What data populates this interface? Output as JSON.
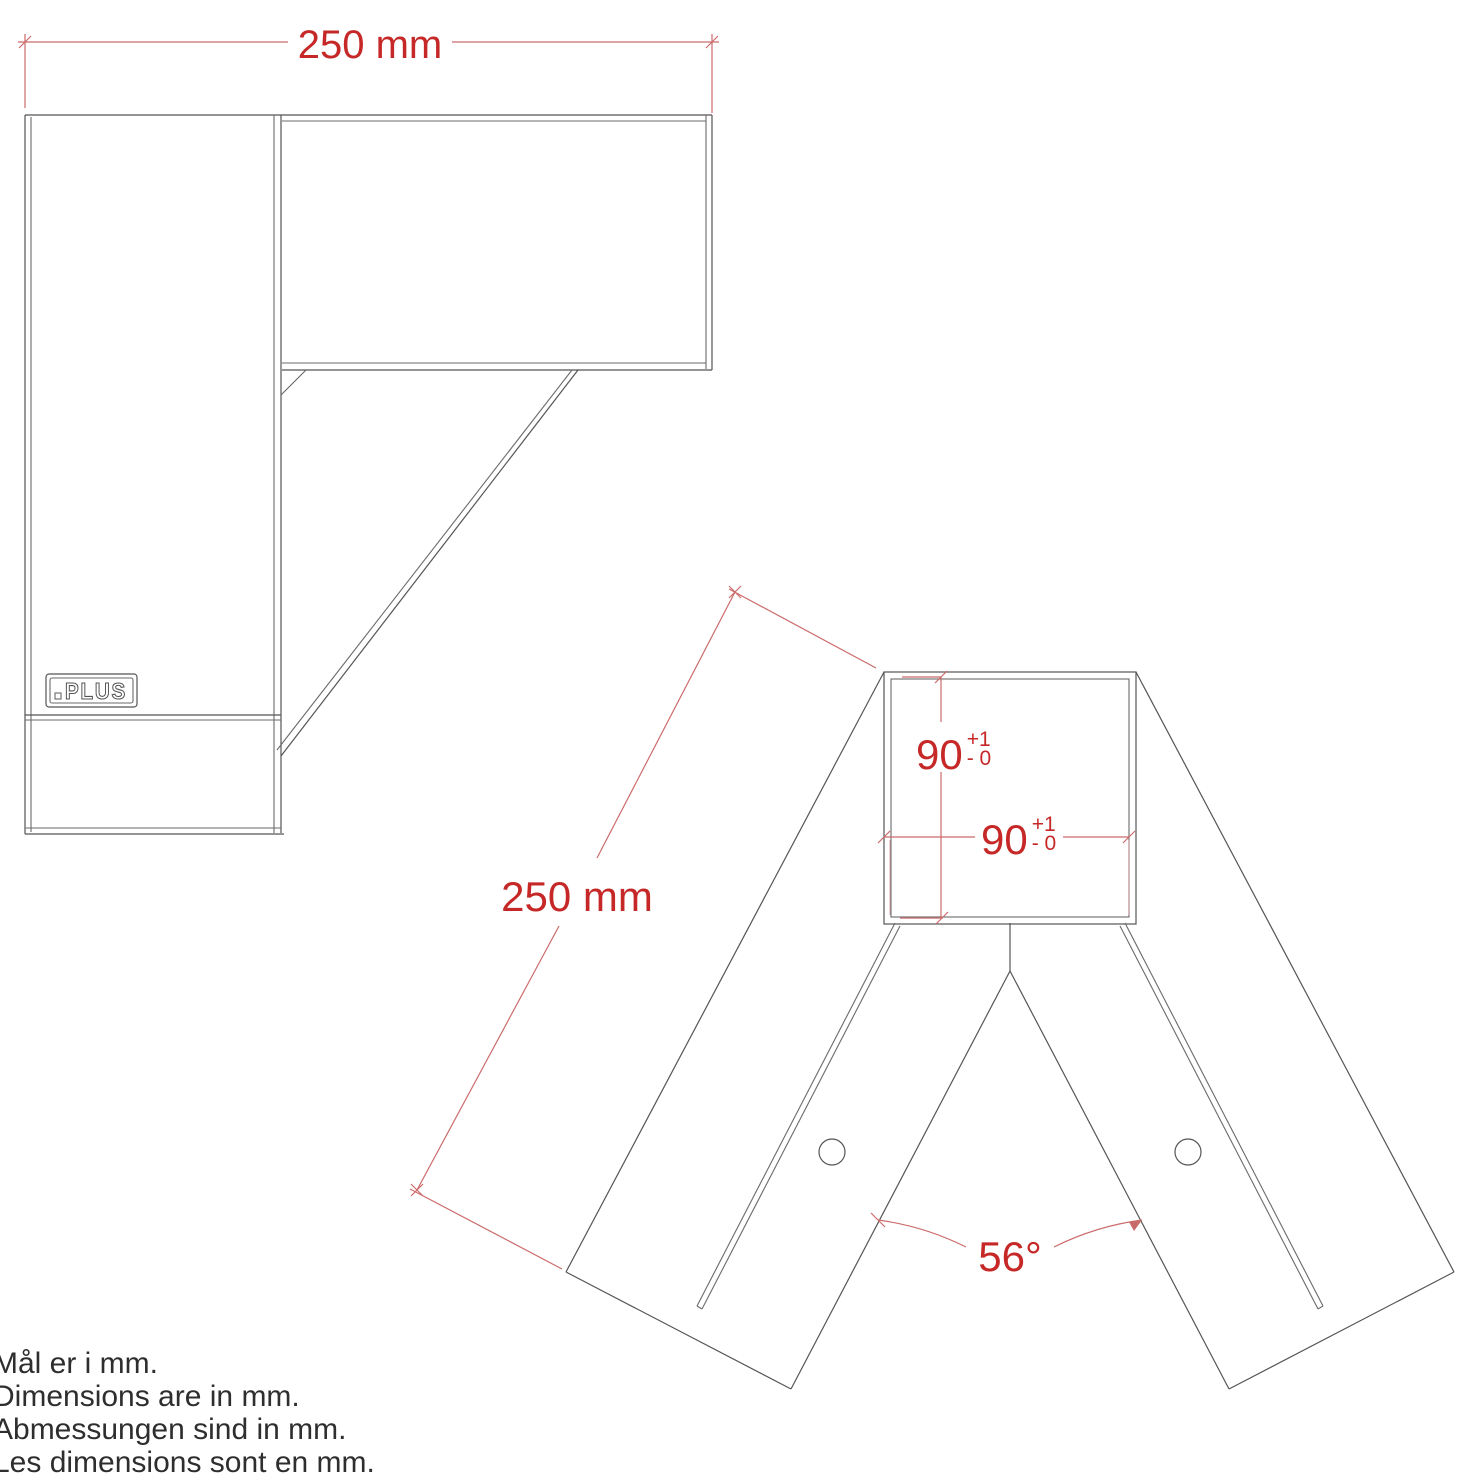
{
  "canvas": {
    "background": "#ffffff",
    "drawing_line_color": "#555555",
    "dimension_line_color": "#cc6b6b",
    "dimension_text_color": "#c62828"
  },
  "side_view": {
    "description": "post-bracket-side-view",
    "width_dim_label": "250 mm",
    "logo_text": "PLUS"
  },
  "front_view": {
    "description": "a-frame-bracket-front-view",
    "leg_length_dim_label": "250 mm",
    "inner_height_dim": {
      "value": "90",
      "tol_upper": "+1",
      "tol_lower": "- 0"
    },
    "inner_width_dim": {
      "value": "90",
      "tol_upper": "+1",
      "tol_lower": "- 0"
    },
    "leg_angle_dim_label": "56°"
  },
  "notes": [
    "Mål er i mm.",
    "Dimensions are in mm.",
    "Abmessungen sind in mm.",
    "Les dimensions sont en mm."
  ]
}
